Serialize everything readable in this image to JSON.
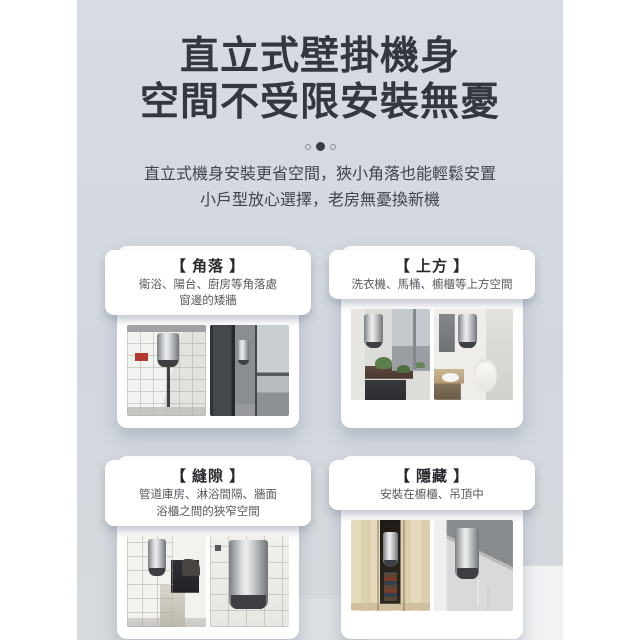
{
  "theme": {
    "page_margin_color": "#ffffff",
    "stage_background": "#d4d9e0",
    "title_color": "#33383e",
    "card_background": "#ffffff",
    "dot_active_color": "#383d43",
    "heater_silver": "#c6c9cb"
  },
  "header": {
    "title_line1": "直立式壁掛機身",
    "title_line2": "空間不受限安裝無憂",
    "subtitle_line1": "直立式機身安裝更省空間，狹小角落也能輕鬆安置",
    "subtitle_line2": "小戶型放心選擇，老房無憂換新機"
  },
  "carousel": {
    "dot_count": 3,
    "active_index": 2
  },
  "cards": [
    {
      "title": "【 角落 】",
      "desc_line1": "衛浴、陽台、廚房等角落處",
      "desc_line2": "窗邊的矮牆",
      "photos": [
        "bathroom-tiled-corner-with-wall-heater",
        "balcony-corner-with-wall-heater"
      ]
    },
    {
      "title": "【 上方 】",
      "desc_line1": "洗衣機、馬桶、櫥櫃等上方空間",
      "photos": [
        "heater-above-balcony-counter-with-plants",
        "heater-above-toilet-in-bathroom"
      ]
    },
    {
      "title": "【 縫隙 】",
      "desc_line1": "管道庫房、淋浴間隔、牆面",
      "desc_line2": "浴櫃之間的狹窄空間",
      "photos": [
        "heater-in-narrow-gap-above-washing-machine",
        "heater-closeup-on-tiled-wall"
      ]
    },
    {
      "title": "【 隱藏 】",
      "desc_line1": "安裝在櫥櫃、吊頂中",
      "photos": [
        "heater-hidden-inside-wooden-cabinet",
        "heater-hidden-under-ceiling"
      ]
    }
  ]
}
